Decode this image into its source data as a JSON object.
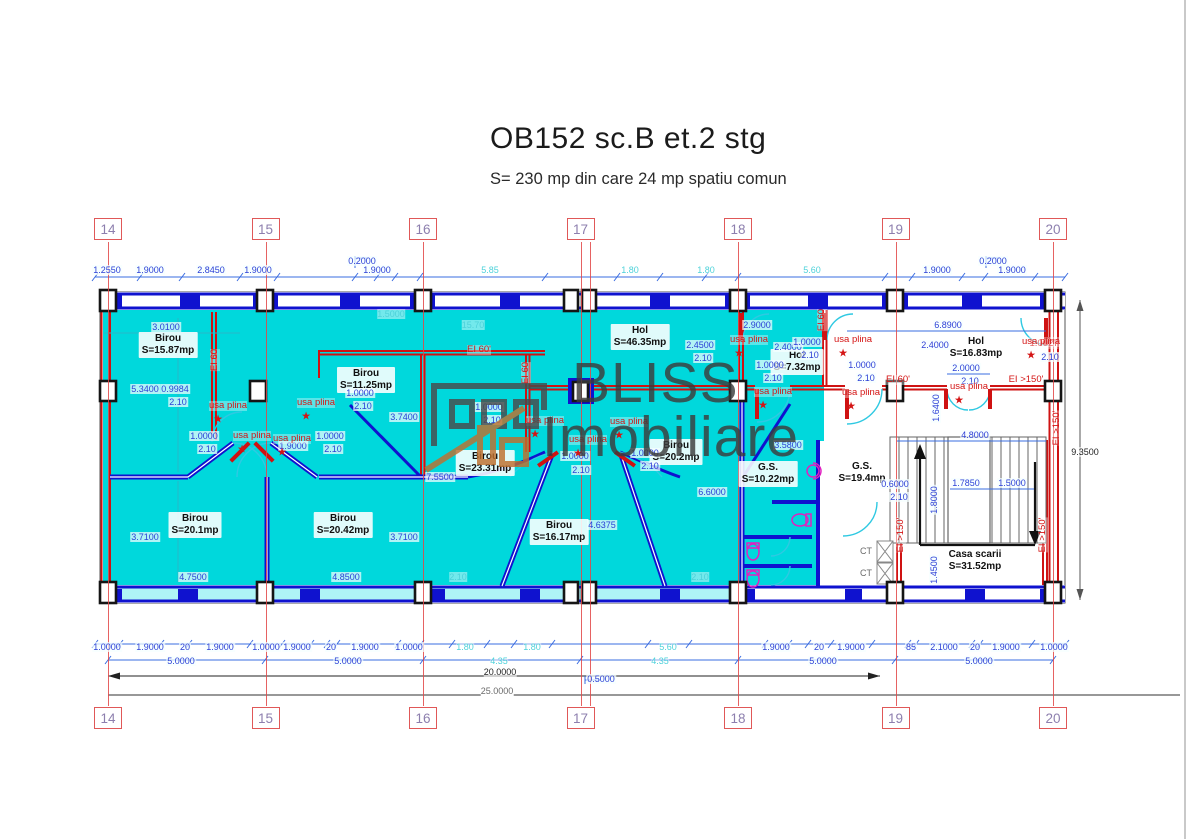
{
  "header": {
    "title": "OB152 sc.B et.2 stg",
    "subtitle": "S= 230 mp din  care 24 mp spatiu comun"
  },
  "watermark": {
    "line1": "BLISS",
    "line2": "Imobiliare",
    "house_gray": "#4a4a4a",
    "house_orange": "#bf702e"
  },
  "colors": {
    "room_fill": "#00d8dc",
    "wall_blue": "#0f12cf",
    "wall_red": "#cf1212",
    "dim_blue": "#2b3fd6",
    "dim_cyan": "#4ed2da",
    "grid_red": "#e05858",
    "grid_number": "#8d7fae",
    "fixture_magenta": "#e020c0"
  },
  "grid": {
    "numbers": [
      "14",
      "15",
      "16",
      "17",
      "18",
      "19",
      "20"
    ],
    "xs": [
      108,
      265.5,
      423,
      580.5,
      738,
      895.5,
      1053
    ],
    "extra_line_x": 590,
    "top_y": 218,
    "bottom_y": 707
  },
  "rooms": [
    {
      "name": "Birou",
      "area": "S=15.87mp",
      "x": 168,
      "y": 345
    },
    {
      "name": "Birou",
      "area": "S=11.25mp",
      "x": 366,
      "y": 380
    },
    {
      "name": "Birou",
      "area": "S=23.31mp",
      "x": 485,
      "y": 463
    },
    {
      "name": "Birou",
      "area": "S=20.1mp",
      "x": 195,
      "y": 525
    },
    {
      "name": "Birou",
      "area": "S=20.42mp",
      "x": 343,
      "y": 525
    },
    {
      "name": "Birou",
      "area": "S=16.17mp",
      "x": 559,
      "y": 532
    },
    {
      "name": "Birou",
      "area": "S=20.2mp",
      "x": 676,
      "y": 452
    },
    {
      "name": "Hol",
      "area": "S=46.35mp",
      "x": 640,
      "y": 337
    },
    {
      "name": "Hol",
      "area": "S=7.32mp",
      "x": 797,
      "y": 362
    },
    {
      "name": "Hol",
      "area": "S=16.83mp",
      "x": 976,
      "y": 348
    },
    {
      "name": "G.S.",
      "area": "S=10.22mp",
      "x": 768,
      "y": 474
    },
    {
      "name": "G.S.",
      "area": "S=19.4mp",
      "x": 862,
      "y": 473
    },
    {
      "name": "Casa scarii",
      "area": "S=31.52mp",
      "x": 975,
      "y": 561
    }
  ],
  "labels": [
    [
      "1.2550",
      107,
      270,
      "b"
    ],
    [
      "1.9000",
      150,
      270,
      "b"
    ],
    [
      "2.8450",
      211,
      270,
      "b"
    ],
    [
      "1.9000",
      258,
      270,
      "b"
    ],
    [
      "0.2000",
      362,
      261,
      "b"
    ],
    [
      "1.9000",
      377,
      270,
      "b"
    ],
    [
      "5.85",
      490,
      270,
      "c"
    ],
    [
      "1.80",
      630,
      270,
      "c"
    ],
    [
      "1.80",
      706,
      270,
      "c"
    ],
    [
      "5.60",
      812,
      270,
      "c"
    ],
    [
      "1.9000",
      937,
      270,
      "b"
    ],
    [
      "0.2000",
      993,
      261,
      "b"
    ],
    [
      "1.9000",
      1012,
      270,
      "b"
    ],
    [
      "1.0000",
      107,
      647,
      "b"
    ],
    [
      "1.9000",
      150,
      647,
      "b"
    ],
    [
      "20",
      185,
      647,
      "b"
    ],
    [
      "1.9000",
      220,
      647,
      "b"
    ],
    [
      "1.0000",
      266,
      647,
      "b"
    ],
    [
      "1.9000",
      297,
      647,
      "b"
    ],
    [
      "20",
      331,
      647,
      "b"
    ],
    [
      "1.9000",
      365,
      647,
      "b"
    ],
    [
      "1.0000",
      409,
      647,
      "b"
    ],
    [
      "1.80",
      465,
      647,
      "c"
    ],
    [
      "1.80",
      532,
      647,
      "c"
    ],
    [
      "5.60",
      668,
      647,
      "c"
    ],
    [
      "1.9000",
      776,
      647,
      "b"
    ],
    [
      "20",
      819,
      647,
      "b"
    ],
    [
      "1.9000",
      851,
      647,
      "b"
    ],
    [
      "85",
      911,
      647,
      "b"
    ],
    [
      "2.1000",
      944,
      647,
      "b"
    ],
    [
      "20",
      975,
      647,
      "b"
    ],
    [
      "1.9000",
      1006,
      647,
      "b"
    ],
    [
      "1.0000",
      1054,
      647,
      "b"
    ],
    [
      "5.0000",
      181,
      661,
      "b"
    ],
    [
      "5.0000",
      348,
      661,
      "b"
    ],
    [
      "4.35",
      499,
      661,
      "c"
    ],
    [
      "4.35",
      660,
      661,
      "c"
    ],
    [
      "5.0000",
      823,
      661,
      "b"
    ],
    [
      "5.0000",
      979,
      661,
      "b"
    ],
    [
      "20.0000",
      500,
      672,
      "k"
    ],
    [
      "0.5000",
      601,
      679,
      "b"
    ],
    [
      "25.0000",
      497,
      691,
      "g"
    ],
    [
      "3.0100",
      166,
      327,
      "b"
    ],
    [
      "5.3400",
      145,
      389,
      "b"
    ],
    [
      "0.9984",
      175,
      389,
      "b"
    ],
    [
      "2.10",
      178,
      402,
      "b"
    ],
    [
      "1.0000",
      204,
      436,
      "b"
    ],
    [
      "2.10",
      207,
      449,
      "b"
    ],
    [
      "1.9000",
      293,
      446,
      "b"
    ],
    [
      "1.0000",
      330,
      436,
      "b"
    ],
    [
      "2.10",
      333,
      449,
      "b"
    ],
    [
      "1.0000",
      360,
      393,
      "b"
    ],
    [
      "2.10",
      363,
      406,
      "b"
    ],
    [
      "1.5000",
      391,
      314,
      "c"
    ],
    [
      "15.70",
      473,
      325,
      "c"
    ],
    [
      "3.7400",
      404,
      417,
      "b"
    ],
    [
      "7.5500",
      440,
      477,
      "b"
    ],
    [
      "3.7100",
      145,
      537,
      "b"
    ],
    [
      "4.7500",
      193,
      577,
      "b"
    ],
    [
      "4.8500",
      346,
      577,
      "b"
    ],
    [
      "3.7100",
      404,
      537,
      "b"
    ],
    [
      "1.0000",
      489,
      407,
      "b"
    ],
    [
      "2.10",
      492,
      420,
      "b"
    ],
    [
      "1.0000",
      575,
      456,
      "b"
    ],
    [
      "2.10",
      581,
      470,
      "b"
    ],
    [
      "1.0000",
      645,
      453,
      "b"
    ],
    [
      "2.10",
      650,
      466,
      "b"
    ],
    [
      "4.6375",
      602,
      525,
      "b"
    ],
    [
      "6.6000",
      712,
      492,
      "b"
    ],
    [
      "2.10",
      458,
      577,
      "c"
    ],
    [
      "2.10",
      700,
      577,
      "c"
    ],
    [
      "2.9000",
      757,
      325,
      "b"
    ],
    [
      "2.4500",
      700,
      345,
      "b"
    ],
    [
      "2.10",
      703,
      358,
      "b"
    ],
    [
      "2.4000",
      788,
      347,
      "b"
    ],
    [
      "1.0000",
      807,
      342,
      "b"
    ],
    [
      "2.10",
      810,
      355,
      "b"
    ],
    [
      "1.0000",
      770,
      365,
      "b"
    ],
    [
      "2.10",
      773,
      378,
      "b"
    ],
    [
      "1.0000",
      862,
      365,
      "b"
    ],
    [
      "2.10",
      866,
      378,
      "b"
    ],
    [
      "2.4000",
      935,
      345,
      "b"
    ],
    [
      "6.8900",
      948,
      325,
      "b"
    ],
    [
      "2.0000",
      966,
      368,
      "b"
    ],
    [
      "2.10",
      970,
      381,
      "b"
    ],
    [
      "0.6000",
      895,
      484,
      "b"
    ],
    [
      "2.10",
      899,
      497,
      "b"
    ],
    [
      "3.5800",
      788,
      445,
      "b"
    ],
    [
      "1.7850",
      966,
      483,
      "b"
    ],
    [
      "1.5000",
      1012,
      483,
      "b"
    ],
    [
      "4.8000",
      975,
      435,
      "b"
    ],
    [
      "1.0027",
      1044,
      344,
      "r"
    ],
    [
      "2.10",
      1050,
      357,
      "b"
    ],
    [
      "9.3500",
      1085,
      452,
      "k"
    ],
    [
      "1.6400",
      936,
      408,
      "b",
      -90
    ],
    [
      "1.8000",
      934,
      500,
      "b",
      -90
    ],
    [
      "1.4500",
      934,
      570,
      "b",
      -90
    ],
    [
      "usa plina",
      228,
      406,
      "r",
      0,
      1
    ],
    [
      "usa plina",
      252,
      436,
      "r",
      0,
      1
    ],
    [
      "usa plina",
      292,
      439,
      "r",
      0,
      1
    ],
    [
      "usa plina",
      316,
      403,
      "r",
      0,
      1
    ],
    [
      "usa plina",
      545,
      421,
      "r",
      0,
      1
    ],
    [
      "usa plina",
      588,
      440,
      "r",
      0,
      1
    ],
    [
      "usa plina",
      629,
      422,
      "r",
      0,
      1
    ],
    [
      "usa plina",
      749,
      340,
      "r",
      0,
      1
    ],
    [
      "usa plina",
      853,
      340,
      "r",
      0,
      1
    ],
    [
      "usa plina",
      773,
      392,
      "r",
      0,
      1
    ],
    [
      "usa plina",
      861,
      393,
      "r",
      0,
      1
    ],
    [
      "usa plina",
      969,
      387,
      "r",
      0,
      1
    ],
    [
      "usa plina",
      1041,
      342,
      "r",
      0,
      1
    ],
    [
      "EI 60",
      215,
      360,
      "r",
      -90
    ],
    [
      "EI 60'",
      479,
      350,
      "r"
    ],
    [
      "EI 60",
      526,
      373,
      "r",
      -90
    ],
    [
      "EI 60",
      822,
      320,
      "r",
      -90
    ],
    [
      "EI 60'",
      898,
      380,
      "r"
    ],
    [
      "EI >150'",
      1026,
      380,
      "r"
    ],
    [
      "EI >150'",
      901,
      535,
      "r",
      -90
    ],
    [
      "EI >150'",
      1043,
      535,
      "r",
      -90
    ],
    [
      "EI >150'",
      1057,
      428,
      "r",
      -90
    ],
    [
      "CT",
      866,
      551,
      "g"
    ],
    [
      "CT",
      866,
      573,
      "g"
    ]
  ]
}
